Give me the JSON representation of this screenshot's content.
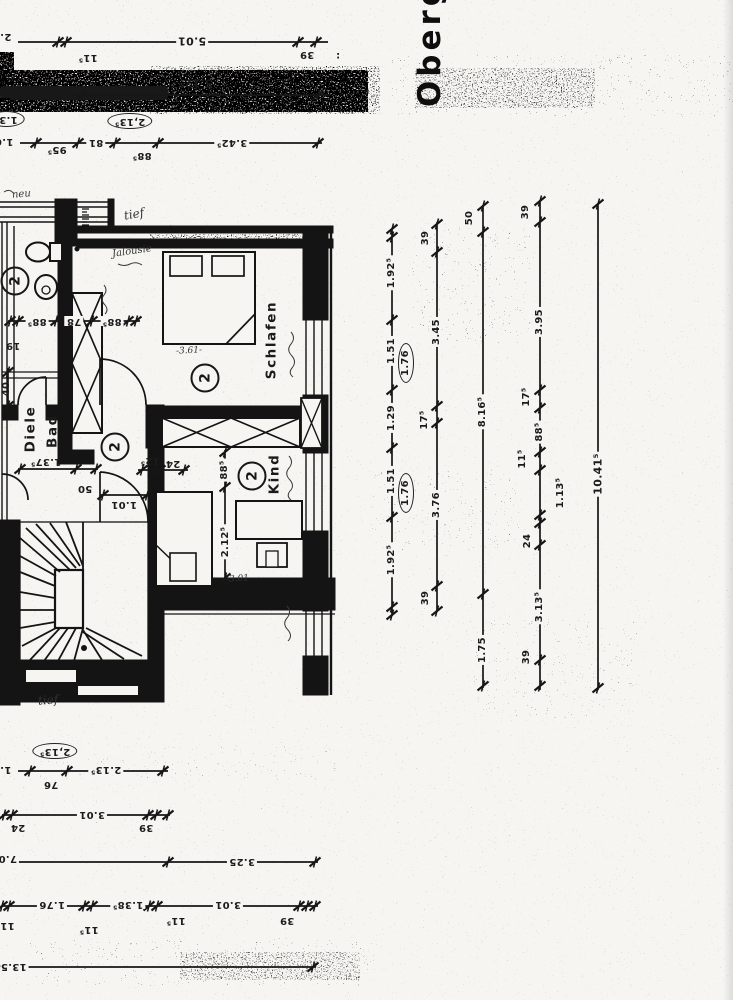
{
  "title": {
    "text": "Oberg"
  },
  "rooms": {
    "schlafen": "Schlafen",
    "kind": "Kind",
    "diele": "Diele",
    "bad": "Bad",
    "symbol": "2"
  },
  "dims": {
    "top1": [
      "2.7",
      "11⁵",
      "5.01",
      "39",
      ":"
    ],
    "top2": [
      "5.12⁵"
    ],
    "top3": {
      "edge_circled": "1.3⁵",
      "edge": "1.6",
      "circled": "2,13⁵",
      "labels": [
        "95⁵",
        "81",
        "88⁵",
        "3.42⁵"
      ]
    },
    "plan_row": [
      "88⁵",
      "78",
      "88⁵"
    ],
    "plan_left": [
      "19",
      "40"
    ],
    "diele": [
      "1.37⁵",
      "50",
      "1.01",
      "12⁵",
      "24"
    ],
    "kind": [
      "88⁵",
      "2.12⁵"
    ],
    "col1": [
      "1.92⁵",
      "1.51",
      "1.29",
      "1.51",
      "1.92⁵"
    ],
    "col1_circled": "1.76",
    "col2": [
      "39",
      "3.45",
      "17⁵",
      "3.76",
      "39"
    ],
    "col3": [
      "50",
      "8.16⁵",
      "1.75"
    ],
    "col4": [
      "39",
      "3.95",
      "17⁵",
      "88⁵",
      "11⁵",
      "1.13⁵",
      "24",
      "3.13⁵",
      "39"
    ],
    "col5": [
      "10.41⁵"
    ],
    "bottom1": {
      "edge": "1.2",
      "circled": "2,13⁵",
      "labels": [
        "76",
        "2.13⁵"
      ]
    },
    "bottom2": [
      "24",
      "3.01",
      "39"
    ],
    "bottom3": [
      "7.04",
      "3.25"
    ],
    "bottom4": [
      "11⁵",
      "1.76",
      "11⁵",
      "1.38⁵",
      "11⁵",
      "3.01",
      "39"
    ],
    "bottom5": [
      "13.54"
    ]
  },
  "notes": {
    "neu": "neu",
    "tief_top": "tief",
    "jalousie": "Jalousie",
    "schlafen_hw": "-3.61-",
    "kind_hw": "-3.01-",
    "tief_bottom": "tief"
  }
}
